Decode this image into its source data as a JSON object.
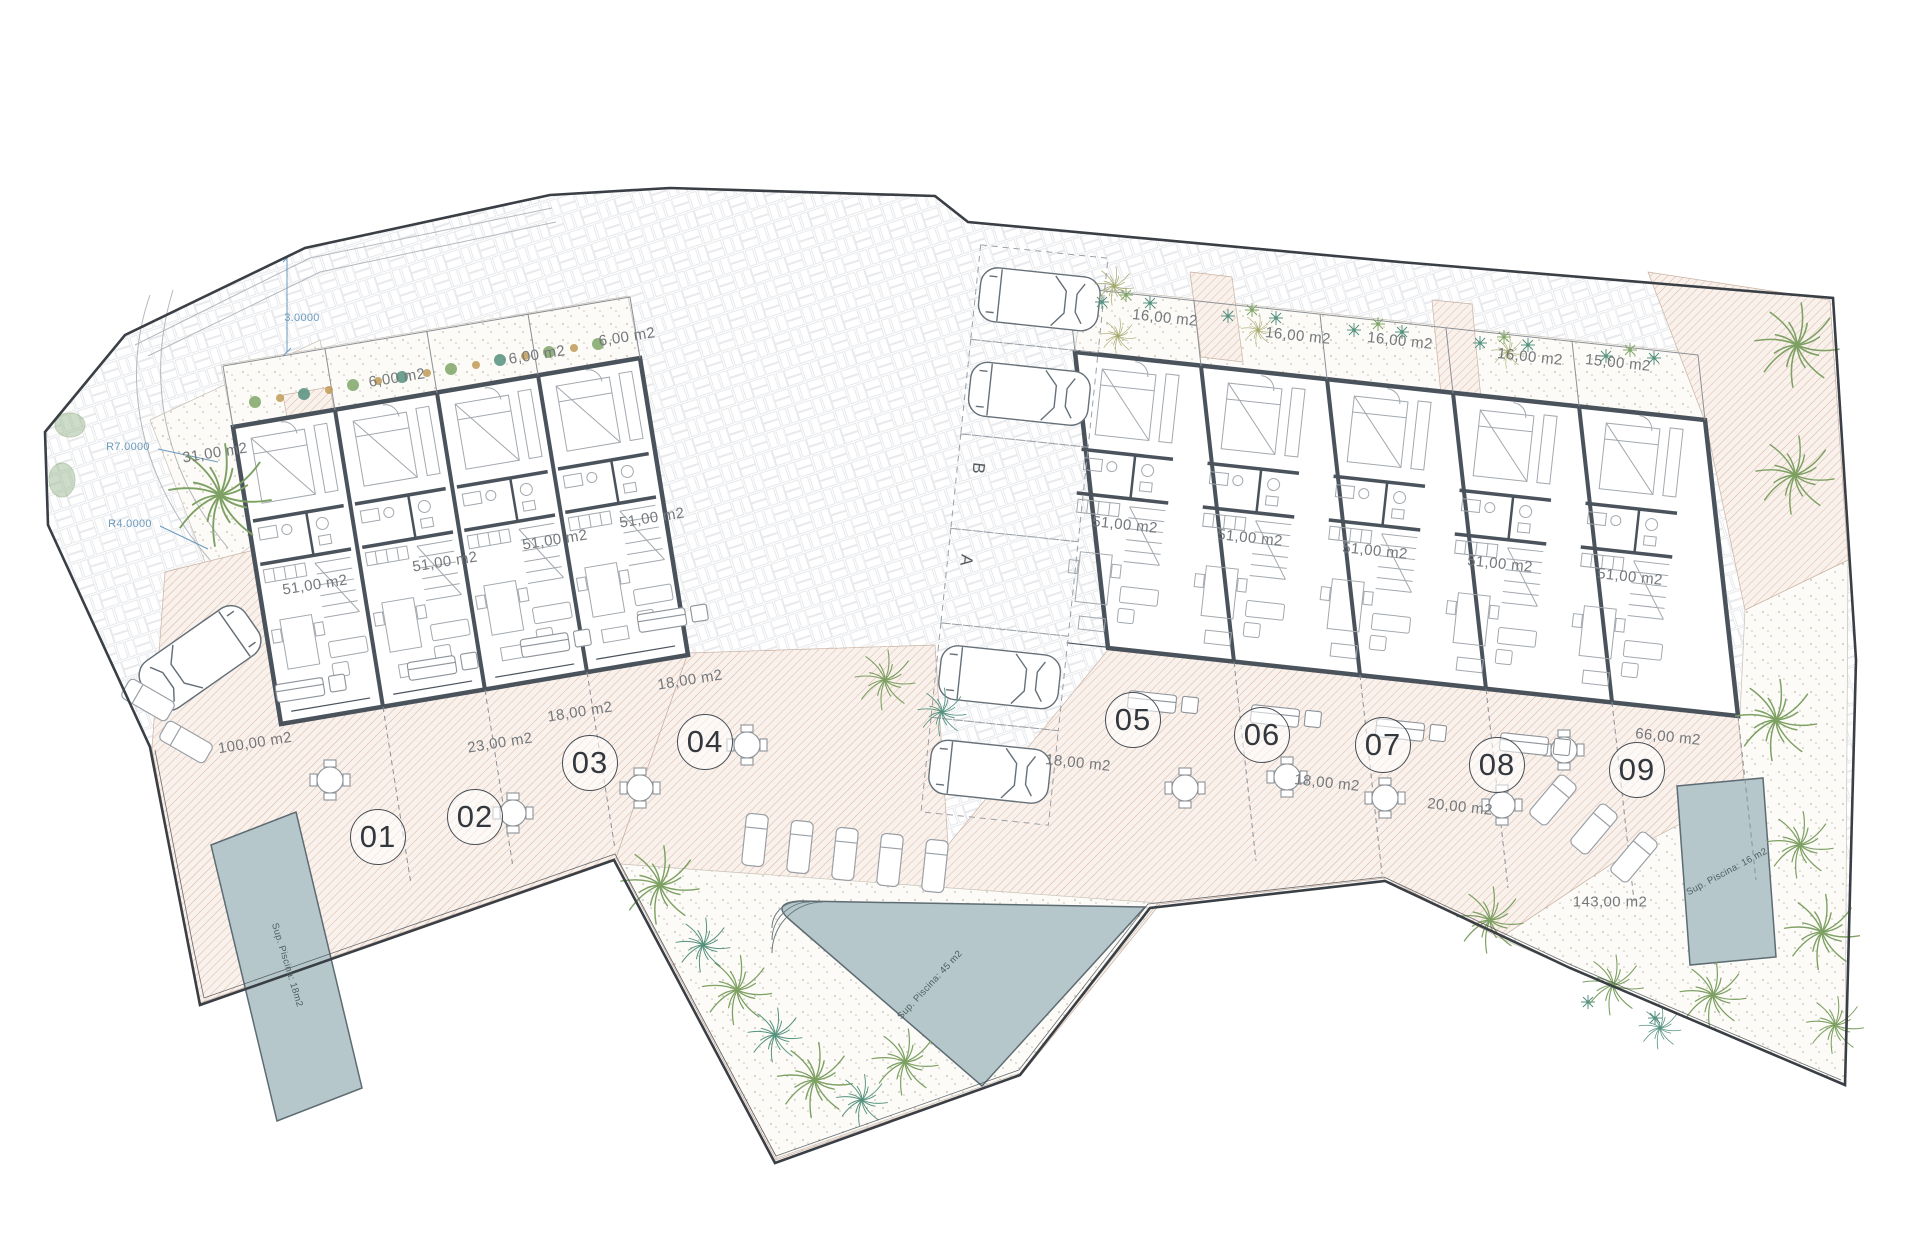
{
  "plan": {
    "kind": "architectural site plan",
    "colors": {
      "wall": "#4a525c",
      "boundary": "#3a3f45",
      "hatch_line": "#dcb4a1",
      "pool_fill": "#b5c7cb",
      "palm_green": "#7da063",
      "palm_teal": "#55917f",
      "palm_olive": "#a3a86b",
      "dimension_blue": "#6d9bbd",
      "label_gray": "#74787c"
    }
  },
  "plot_numbers": [
    {
      "text": "01",
      "x": 378,
      "y": 837
    },
    {
      "text": "02",
      "x": 475,
      "y": 817
    },
    {
      "text": "03",
      "x": 590,
      "y": 763
    },
    {
      "text": "04",
      "x": 705,
      "y": 742
    },
    {
      "text": "05",
      "x": 1133,
      "y": 720
    },
    {
      "text": "06",
      "x": 1262,
      "y": 735
    },
    {
      "text": "07",
      "x": 1383,
      "y": 745
    },
    {
      "text": "08",
      "x": 1497,
      "y": 765
    },
    {
      "text": "09",
      "x": 1637,
      "y": 770
    }
  ],
  "area_labels": [
    {
      "text": "6,00 m2",
      "x": 397,
      "y": 378,
      "r": -9
    },
    {
      "text": "6,00 m2",
      "x": 537,
      "y": 355,
      "r": -9
    },
    {
      "text": "6,00 m2",
      "x": 627,
      "y": 337,
      "r": -9
    },
    {
      "text": "31,00 m2",
      "x": 215,
      "y": 453,
      "r": -9
    },
    {
      "text": "51,00 m2",
      "x": 315,
      "y": 585,
      "r": -9
    },
    {
      "text": "51,00 m2",
      "x": 445,
      "y": 562,
      "r": -9
    },
    {
      "text": "51,00 m2",
      "x": 555,
      "y": 540,
      "r": -9
    },
    {
      "text": "51,00 m2",
      "x": 652,
      "y": 518,
      "r": -9
    },
    {
      "text": "100,00 m2",
      "x": 255,
      "y": 743,
      "r": -9
    },
    {
      "text": "23,00 m2",
      "x": 500,
      "y": 743,
      "r": -9
    },
    {
      "text": "18,00 m2",
      "x": 580,
      "y": 712,
      "r": -9
    },
    {
      "text": "18,00 m2",
      "x": 690,
      "y": 680,
      "r": -9
    },
    {
      "text": "16,00 m2",
      "x": 1165,
      "y": 318,
      "r": 6
    },
    {
      "text": "16,00 m2",
      "x": 1298,
      "y": 336,
      "r": 6
    },
    {
      "text": "16,00 m2",
      "x": 1400,
      "y": 341,
      "r": 6
    },
    {
      "text": "16,00 m2",
      "x": 1530,
      "y": 357,
      "r": 6
    },
    {
      "text": "15,00 m2",
      "x": 1618,
      "y": 363,
      "r": 6
    },
    {
      "text": "51,00 m2",
      "x": 1125,
      "y": 525,
      "r": 6
    },
    {
      "text": "51,00 m2",
      "x": 1250,
      "y": 538,
      "r": 6
    },
    {
      "text": "51,00 m2",
      "x": 1375,
      "y": 551,
      "r": 6
    },
    {
      "text": "51,00 m2",
      "x": 1500,
      "y": 564,
      "r": 6
    },
    {
      "text": "51,00 m2",
      "x": 1630,
      "y": 577,
      "r": 6
    },
    {
      "text": "18,00 m2",
      "x": 1078,
      "y": 763,
      "r": 6
    },
    {
      "text": "18,00 m2",
      "x": 1327,
      "y": 783,
      "r": 6
    },
    {
      "text": "20,00 m2",
      "x": 1460,
      "y": 807,
      "r": 6
    },
    {
      "text": "66,00 m2",
      "x": 1668,
      "y": 737,
      "r": 6
    },
    {
      "text": "143,00 m2",
      "x": 1610,
      "y": 902,
      "r": 0
    }
  ],
  "dimension_labels": [
    {
      "text": "3.0000",
      "x": 302,
      "y": 318,
      "r": 0
    },
    {
      "text": "R7.0000",
      "x": 128,
      "y": 447,
      "r": 0
    },
    {
      "text": "R4.0000",
      "x": 130,
      "y": 524,
      "r": 0
    }
  ],
  "parking_spots": [
    {
      "text": "B",
      "x": 978,
      "y": 468,
      "r": 96
    },
    {
      "text": "A",
      "x": 966,
      "y": 560,
      "r": 96
    }
  ],
  "pools": [
    {
      "label": "Sup. Piscina: 18m2",
      "x": 287,
      "y": 965,
      "r": 73
    },
    {
      "label": "Sup. Piscina: 45 m2",
      "x": 930,
      "y": 985,
      "r": -47
    },
    {
      "label": "Sup. Piscina: 16 m2",
      "x": 1727,
      "y": 872,
      "r": -28
    }
  ]
}
